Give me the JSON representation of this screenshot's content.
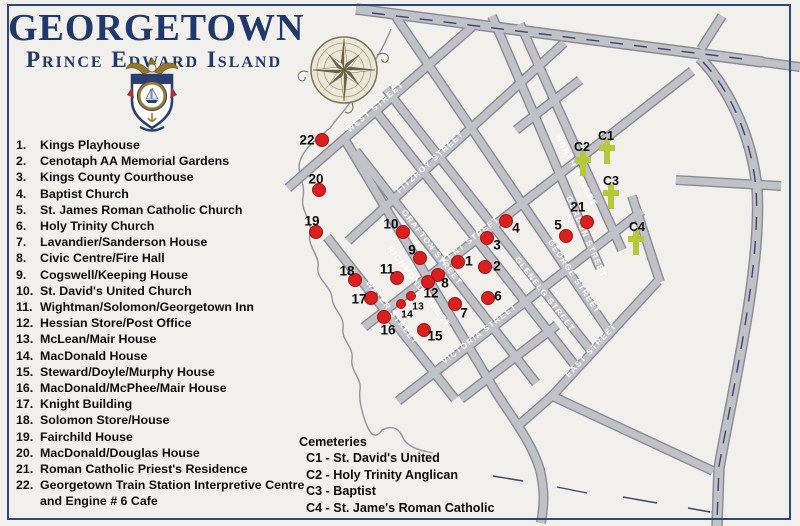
{
  "header": {
    "title": "GEORGETOWN",
    "subtitle": "Prince Edward Island"
  },
  "legend": {
    "items": [
      {
        "num": "1.",
        "label": "Kings Playhouse"
      },
      {
        "num": "2.",
        "label": "Cenotaph AA Memorial Gardens"
      },
      {
        "num": "3.",
        "label": "Kings County Courthouse"
      },
      {
        "num": "4.",
        "label": "Baptist Church"
      },
      {
        "num": "5.",
        "label": "St. James Roman Catholic Church"
      },
      {
        "num": "6.",
        "label": "Holy Trinity Church"
      },
      {
        "num": "7.",
        "label": "Lavandier/Sanderson House"
      },
      {
        "num": "8.",
        "label": "Civic Centre/Fire Hall"
      },
      {
        "num": "9.",
        "label": "Cogswell/Keeping House"
      },
      {
        "num": "10.",
        "label": "St. David's United Church"
      },
      {
        "num": "11.",
        "label": "Wightman/Solomon/Georgetown Inn"
      },
      {
        "num": "12.",
        "label": "Hessian Store/Post Office"
      },
      {
        "num": "13.",
        "label": "McLean/Mair House"
      },
      {
        "num": "14.",
        "label": "MacDonald House"
      },
      {
        "num": "15.",
        "label": "Steward/Doyle/Murphy House"
      },
      {
        "num": "16.",
        "label": "MacDonald/McPhee/Mair House"
      },
      {
        "num": "17.",
        "label": "Knight Building"
      },
      {
        "num": "18.",
        "label": "Solomon Store/House"
      },
      {
        "num": "19.",
        "label": "Fairchild House"
      },
      {
        "num": "20.",
        "label": "MacDonald/Douglas House"
      },
      {
        "num": "21.",
        "label": "Roman Catholic Priest's Residence"
      },
      {
        "num": "22.",
        "label": "Georgetown Train Station Interpretive Centre and Engine # 6 Cafe"
      }
    ]
  },
  "cemeteries": {
    "title": "Cemeteries",
    "items": [
      "C1 - St. David's United",
      "C2 - Holy Trinity Anglican",
      "C3 - Baptist",
      "C4 - St. Jame's Roman Catholic"
    ]
  },
  "map": {
    "street_labels": [
      {
        "name": "WEST STREET",
        "x": 377,
        "y": 109,
        "rot": -41
      },
      {
        "name": "FITZROY STREET",
        "x": 432,
        "y": 164,
        "rot": -42
      },
      {
        "name": "KENT STREET",
        "x": 472,
        "y": 242,
        "rot": -38
      },
      {
        "name": "VICTORIA STREET",
        "x": 481,
        "y": 336,
        "rot": -38
      },
      {
        "name": "EAST STREET",
        "x": 593,
        "y": 352,
        "rot": -47
      },
      {
        "name": "WATER STREET",
        "x": 390,
        "y": 314,
        "rot": 52
      },
      {
        "name": "RICHMOND STREET",
        "x": 417,
        "y": 288,
        "rot": 53
      },
      {
        "name": "GRAFTON STREET",
        "x": 430,
        "y": 249,
        "rot": 52
      },
      {
        "name": "GLENELG STREET",
        "x": 543,
        "y": 296,
        "rot": 52
      },
      {
        "name": "GEORGE STREET",
        "x": 572,
        "y": 278,
        "rot": 56
      },
      {
        "name": "GORDON STREET",
        "x": 584,
        "y": 238,
        "rot": 66
      },
      {
        "name": "NORTH STREET",
        "x": 574,
        "y": 172,
        "rot": 62
      }
    ],
    "dots": [
      {
        "n": "1",
        "x": 458,
        "y": 262,
        "lx": 469,
        "ly": 261
      },
      {
        "n": "2",
        "x": 485,
        "y": 267,
        "lx": 497,
        "ly": 266
      },
      {
        "n": "3",
        "x": 487,
        "y": 238,
        "lx": 497,
        "ly": 245
      },
      {
        "n": "4",
        "x": 506,
        "y": 221,
        "lx": 516,
        "ly": 228
      },
      {
        "n": "5",
        "x": 566,
        "y": 236,
        "lx": 558,
        "ly": 225
      },
      {
        "n": "6",
        "x": 488,
        "y": 298,
        "lx": 498,
        "ly": 296
      },
      {
        "n": "7",
        "x": 455,
        "y": 304,
        "lx": 464,
        "ly": 313
      },
      {
        "n": "8",
        "x": 438,
        "y": 275,
        "lx": 445,
        "ly": 283
      },
      {
        "n": "9",
        "x": 420,
        "y": 258,
        "lx": 412,
        "ly": 250
      },
      {
        "n": "10",
        "x": 403,
        "y": 232,
        "lx": 391,
        "ly": 224
      },
      {
        "n": "11",
        "x": 397,
        "y": 278,
        "lx": 387,
        "ly": 269
      },
      {
        "n": "12",
        "x": 428,
        "y": 282,
        "lx": 431,
        "ly": 293
      },
      {
        "n": "13",
        "x": 411,
        "y": 296,
        "lx": 418,
        "ly": 306,
        "small": true
      },
      {
        "n": "14",
        "x": 401,
        "y": 304,
        "lx": 407,
        "ly": 314,
        "small": true
      },
      {
        "n": "15",
        "x": 424,
        "y": 330,
        "lx": 435,
        "ly": 336
      },
      {
        "n": "16",
        "x": 384,
        "y": 317,
        "lx": 388,
        "ly": 330
      },
      {
        "n": "17",
        "x": 371,
        "y": 298,
        "lx": 359,
        "ly": 299
      },
      {
        "n": "18",
        "x": 355,
        "y": 280,
        "lx": 347,
        "ly": 271
      },
      {
        "n": "19",
        "x": 316,
        "y": 232,
        "lx": 312,
        "ly": 221
      },
      {
        "n": "20",
        "x": 319,
        "y": 190,
        "lx": 316,
        "ly": 179
      },
      {
        "n": "21",
        "x": 587,
        "y": 222,
        "lx": 578,
        "ly": 207
      },
      {
        "n": "22",
        "x": 322,
        "y": 140,
        "lx": 307,
        "ly": 140
      }
    ],
    "crosses": [
      {
        "id": "C1",
        "x": 607,
        "y": 151,
        "lx": 606,
        "ly": 136
      },
      {
        "id": "C2",
        "x": 583,
        "y": 163,
        "lx": 582,
        "ly": 147
      },
      {
        "id": "C3",
        "x": 611,
        "y": 196,
        "lx": 611,
        "ly": 181
      },
      {
        "id": "C4",
        "x": 636,
        "y": 242,
        "lx": 637,
        "ly": 227
      }
    ],
    "colors": {
      "dot_red": "#da1f1f",
      "cross_green": "#b5c93a",
      "street_gray": "#c1c1c8",
      "street_casing": "#8b8b96",
      "navy": "#2e4878",
      "title_navy": "#21386b",
      "text_black": "#0d0d0d"
    }
  }
}
